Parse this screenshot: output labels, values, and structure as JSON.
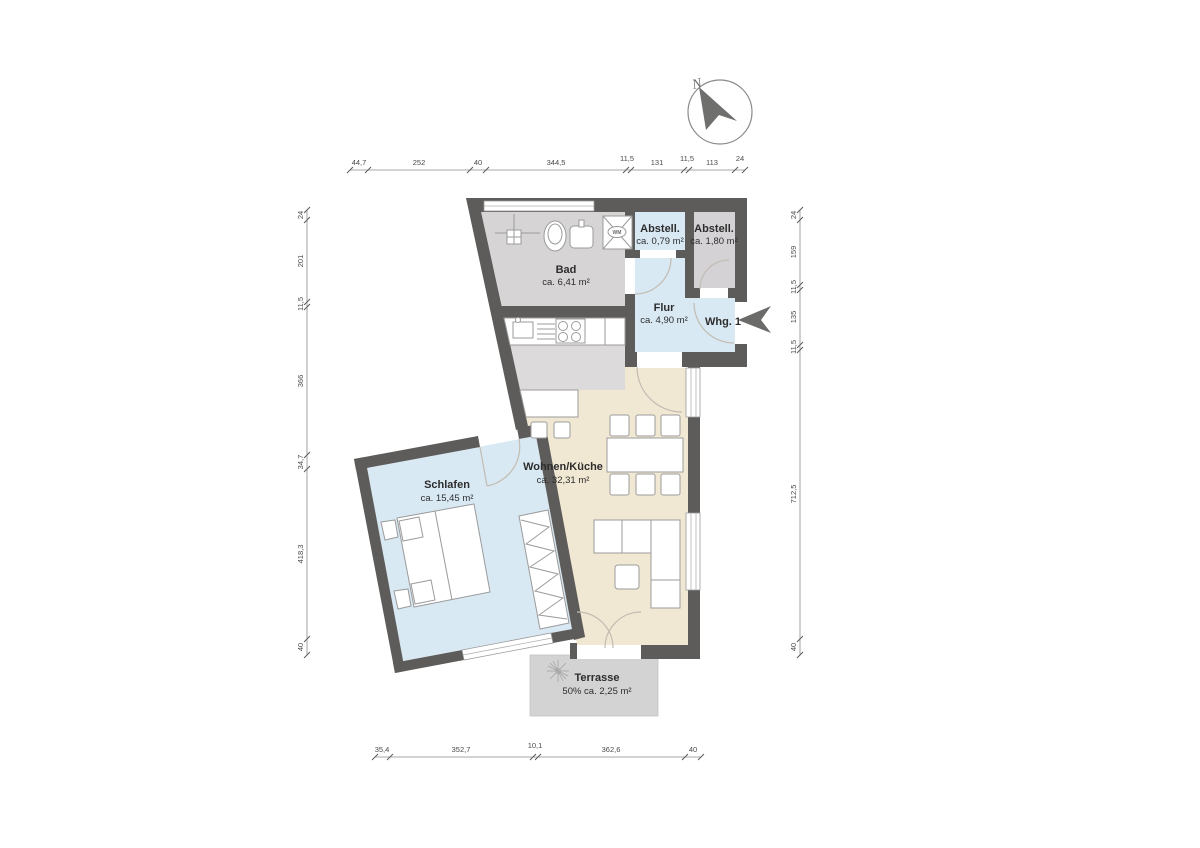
{
  "plan": {
    "unit_label": "Whg. 1",
    "north_label": "N",
    "rooms": {
      "bad": {
        "name": "Bad",
        "area": "ca. 6,41 m²"
      },
      "abstell_small": {
        "name": "Abstell.",
        "area": "ca. 0,79 m²"
      },
      "abstell_large": {
        "name": "Abstell.",
        "area": "ca. 1,80 m²"
      },
      "flur": {
        "name": "Flur",
        "area": "ca. 4,90 m²"
      },
      "wohnen_kueche": {
        "name": "Wohnen/Küche",
        "area": "ca. 32,31 m²"
      },
      "schlafen": {
        "name": "Schlafen",
        "area": "ca. 15,45 m²"
      },
      "terrasse": {
        "name": "Terrasse",
        "area": "50% ca. 2,25 m²"
      }
    },
    "appliances": {
      "washing_machine": "WM"
    },
    "dimensions_cm": {
      "top": [
        "44,7",
        "252",
        "40",
        "344,5",
        "11,5",
        "131",
        "11,5",
        "113",
        "24"
      ],
      "left": [
        "24",
        "201",
        "11,5",
        "366",
        "34,7",
        "418,3",
        "40"
      ],
      "right": [
        "24",
        "159",
        "11,5",
        "135",
        "11,5",
        "712,5",
        "40"
      ],
      "bottom": [
        "35,4",
        "352,7",
        "10,1",
        "362,6",
        "40"
      ]
    },
    "colors": {
      "wall": "#5d5c5a",
      "room_blue": "#d9e9f4",
      "room_gray": "#d7d4d6",
      "room_beige": "#f1e8d4",
      "kitchen_gray": "#dcdada",
      "terrace_gray": "#d3d3d3",
      "accent_dark": "#6b6b69"
    }
  }
}
